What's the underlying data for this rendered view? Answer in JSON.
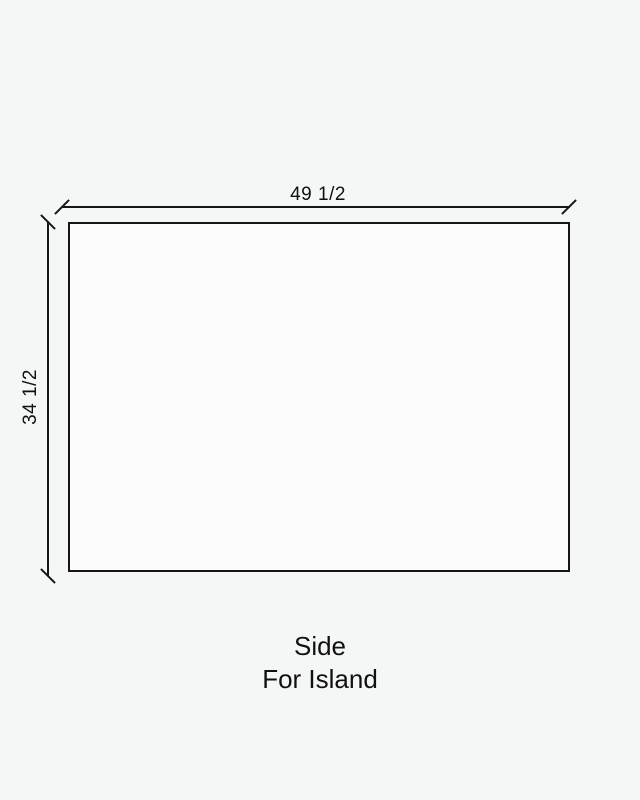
{
  "colors": {
    "background": "#f5f6f6",
    "line": "#161616",
    "panel_fill": "#fcfcfc",
    "text": "#111111"
  },
  "diagram": {
    "width_dimension": {
      "label": "49 1/2"
    },
    "height_dimension": {
      "label": "34 1/2"
    },
    "caption": {
      "line1": "Side",
      "line2": "For Island"
    }
  }
}
